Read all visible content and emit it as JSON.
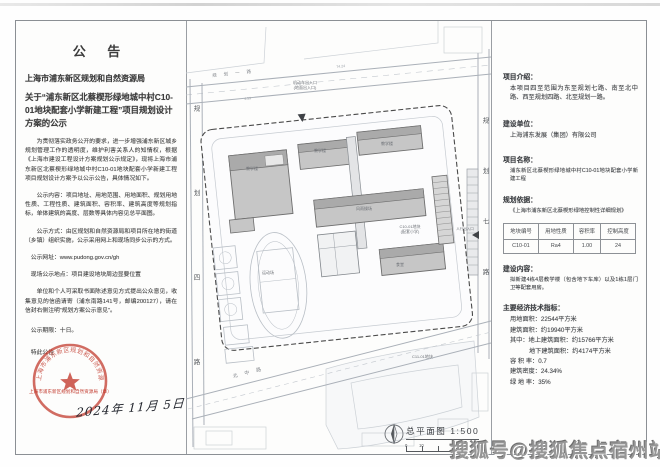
{
  "announcement": {
    "title": "公  告",
    "agency": "上海市浦东新区规划和自然资源局",
    "subject": "关于“浦东新区北蔡楔形绿地城中村C10-01地块配套小学新建工程”项目规划设计方案的公示",
    "paragraphs": [
      "为贯彻落实政务公开的要求，进一步增强浦东新区城乡规划管理工作的透明度，维护利害关系人的知情权，根据《上海市建设工程设计方案规划公示规定》，现将上海市浦东新区北蔡楔形绿地城中村C10-01地块配套小学新建工程项目规划设计方案予以公示公告，具体情况如下。",
      "公示内容：项目地址、用地范围、用地面积、规划用地性质、工程性质、建筑面积、容积率、建筑高度等规划指标，单体建筑的高度、层数等具体内容见总平面图。",
      "公示方式：由区规划和自然资源局和项目所在地的街道（乡镇）组织实施，公示采用网上和现场同步公示的方式。"
    ],
    "website_line": "公示网址：www.pudong.gov.cn/gh",
    "site_notice_line": "现场公示地点：项目建设地块周边显要位置",
    "feedback_line": "单位和个人可采取书面陈述意见方式提出公众意见，收集意见的信函请寄（浦东南路141号，邮编200127），请在信封右侧注明“规划方案公示意见”。",
    "duration_line": "公示期限：十日。",
    "closing_line": "特此公告",
    "stamp_ring_text": "上海市浦东新区规划和自然资源局",
    "stamp_caption": "上海市浦东新区规划和自然资源局（章）",
    "date": "2024年 11月 5日"
  },
  "info_panel": {
    "intro_heading": "项目介绍：",
    "intro_body": "本项目四至范围为东至规划七路、南至北中路、西至规划四路、北至规划一路。",
    "builder_heading": "建设单位：",
    "builder_body": "上海浦东发展（集团）有限公司",
    "name_heading": "项目名称：",
    "name_body": "浦东新区北蔡楔形绿地城中村C10-01地块配套小学新建工程",
    "basis_heading": "规划依据：",
    "basis_body": "《上海市浦东新区北蔡楔形绿地控制性详细规划》",
    "table": {
      "headers": [
        "地块编号",
        "用地性质",
        "容积率",
        "控制高度"
      ],
      "row": [
        "C10-01",
        "Ra4",
        "1.00",
        "24"
      ]
    },
    "content_heading": "建设内容：",
    "content_body": "拟新建4栋4层教学楼（包含地下车库）以及1栋1层门卫等配套用房。",
    "indicators_heading": "主要经济技术指标：",
    "indicators": [
      "用地面积：22544平方米",
      "建筑面积：约19940平方米",
      "其中：地上建筑面积：约15766平方米",
      "地下建筑面积：约4174平方米",
      "容 积 率：0.7",
      "建筑密度：24.34%",
      "绿 地 率：35%"
    ]
  },
  "site_plan": {
    "title": "总平面图  1:500",
    "scale_zero": "0",
    "scale_ten": "10",
    "road_west": "规划四路",
    "road_east": "规划七路",
    "road_north": "规划一路",
    "road_south": "北中路",
    "labels": [
      "机动车出入口\n(地面出入口)",
      "教学楼",
      "教学楼",
      "教学楼",
      "风雨操场",
      "食堂",
      "运动场",
      "C10-01地块\n(配套小学)",
      "C11-01地块",
      "人行出入口",
      "74.24",
      "4.59"
    ]
  },
  "watermark": "搜狐号@搜狐焦点宿州站",
  "colors": {
    "stamp_red": "#c23b2e",
    "building_gray": "#c6c6c6",
    "boundary_dark": "#4a4a4a"
  }
}
